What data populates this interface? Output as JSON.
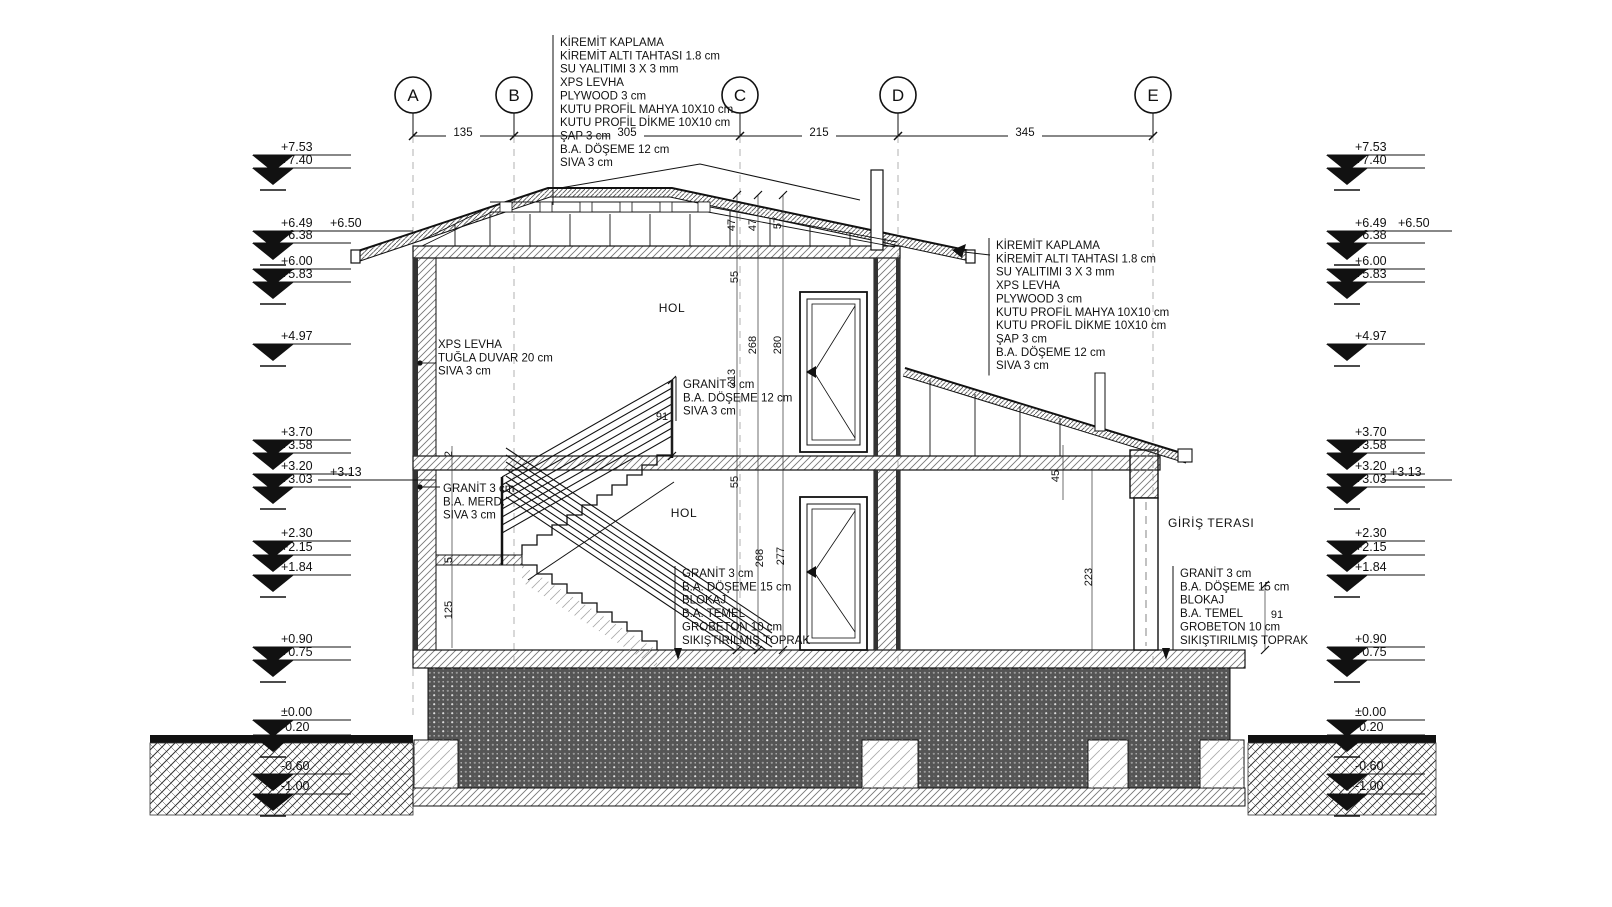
{
  "drawing": {
    "title": "building-cross-section",
    "colors": {
      "line": "#111111",
      "hatch": "#777777",
      "ground_fill": "#555555",
      "dash_grid": "#aaaaaa"
    },
    "grid": {
      "items": [
        {
          "label": "A",
          "x": 413
        },
        {
          "label": "B",
          "x": 514
        },
        {
          "label": "C",
          "x": 740
        },
        {
          "label": "D",
          "x": 898
        },
        {
          "label": "E",
          "x": 1153
        }
      ],
      "circle_y": 95,
      "dim_line_y": 136,
      "spans": [
        {
          "t": "135",
          "x": 463
        },
        {
          "t": "305",
          "x": 627
        },
        {
          "t": "215",
          "x": 819
        },
        {
          "t": "345",
          "x": 1025
        }
      ]
    },
    "levels": {
      "left_tip_x": 273,
      "right_tip_x": 1347,
      "items": [
        {
          "v": "+7.53",
          "y": 151
        },
        {
          "v": "+7.40",
          "y": 164,
          "u": 1
        },
        {
          "v": "+6.49",
          "y": 227
        },
        {
          "v": "+6.38",
          "y": 239,
          "u": 1
        },
        {
          "v": "+6.00",
          "y": 265
        },
        {
          "v": "+5.83",
          "y": 278,
          "u": 1
        },
        {
          "v": "+4.97",
          "y": 340,
          "u": 1
        },
        {
          "v": "+3.70",
          "y": 436
        },
        {
          "v": "+3.58",
          "y": 449,
          "u": 1
        },
        {
          "v": "+3.20",
          "y": 470
        },
        {
          "v": "+3.03",
          "y": 483,
          "u": 1
        },
        {
          "v": "+2.30",
          "y": 537
        },
        {
          "v": "+2.15",
          "y": 551,
          "u": 1
        },
        {
          "v": "+1.84",
          "y": 571,
          "u": 1
        },
        {
          "v": "+0.90",
          "y": 643
        },
        {
          "v": "+0.75",
          "y": 656,
          "u": 1
        },
        {
          "v": "±0.00",
          "y": 716
        },
        {
          "v": "-0.20",
          "y": 731,
          "u": 1
        },
        {
          "v": "-0.60",
          "y": 770
        },
        {
          "v": "-1.00",
          "y": 790,
          "u": 1
        }
      ],
      "extras": [
        {
          "v": "+6.50",
          "x": 330,
          "y": 227,
          "x1": 318,
          "x2": 413,
          "ly": 231
        },
        {
          "v": "+3.13",
          "x": 330,
          "y": 476,
          "x1": 318,
          "x2": 436,
          "ly": 480
        },
        {
          "v": "+6.50",
          "x": 1398,
          "y": 227,
          "x1": 1390,
          "x2": 1452,
          "ly": 231
        },
        {
          "v": "+3.13",
          "x": 1390,
          "y": 476,
          "x1": 1382,
          "x2": 1452,
          "ly": 480
        }
      ]
    },
    "specs": {
      "roof_top": {
        "x": 560,
        "y": 46,
        "bar": true,
        "bar_y2": 205,
        "lines": [
          "KİREMİT KAPLAMA",
          "KİREMİT ALTI TAHTASI 1.8 cm",
          "SU YALITIMI 3 X 3 mm",
          "XPS LEVHA",
          "PLYWOOD 3 cm",
          "KUTU PROFİL MAHYA 10X10 cm",
          "KUTU PROFİL DİKME 10X10 cm",
          "ŞAP 3 cm",
          "B.A. DÖŞEME 12 cm",
          "SIVA 3 cm"
        ]
      },
      "roof_right": {
        "x": 996,
        "y": 249,
        "bar": true,
        "lines": [
          "KİREMİT KAPLAMA",
          "KİREMİT ALTI TAHTASI 1.8 cm",
          "SU YALITIMI 3 X 3 mm",
          "XPS LEVHA",
          "PLYWOOD 3 cm",
          "KUTU PROFİL MAHYA 10X10 cm",
          "KUTU PROFİL DİKME 10X10 cm",
          "ŞAP 3 cm",
          "B.A. DÖŞEME 12 cm",
          "SIVA 3 cm"
        ]
      },
      "wall_left": {
        "x": 438,
        "y": 348,
        "bar": false,
        "lines": [
          "XPS LEVHA",
          "TUĞLA DUVAR 20 cm",
          "SIVA 3 cm"
        ]
      },
      "stair": {
        "x": 443,
        "y": 492,
        "bar": false,
        "lines": [
          "GRANİT 3 cm",
          "B.A. MERD.",
          "SIVA 3 cm"
        ]
      },
      "mid_slab": {
        "x": 683,
        "y": 388,
        "bar": true,
        "lines": [
          "GRANİT 3 cm",
          "B.A. DÖŞEME 12 cm",
          "SIVA 3 cm"
        ]
      },
      "ground_mid": {
        "x": 682,
        "y": 577,
        "bar": true,
        "lines": [
          "GRANİT 3 cm",
          "B.A. DÖŞEME 15 cm",
          "BLOKAJ",
          "B.A. TEMEL",
          "GROBETON 10 cm",
          "SIKIŞTIRILMIŞ TOPRAK"
        ]
      },
      "ground_right": {
        "x": 1180,
        "y": 577,
        "bar": true,
        "lines": [
          "GRANİT 3 cm",
          "B.A. DÖŞEME 15 cm",
          "BLOKAJ",
          "B.A. TEMEL",
          "GROBETON 10 cm",
          "SIKIŞTIRILMIŞ TOPRAK"
        ]
      }
    },
    "rooms": {
      "hol_upper": "HOL",
      "hol_lower": "HOL",
      "giris_terasi": "GİRİŞ TERASI"
    },
    "dims": [
      {
        "t": "47",
        "x": 735,
        "y": 225,
        "r": 1
      },
      {
        "t": "47",
        "x": 756,
        "y": 225,
        "r": 1
      },
      {
        "t": "57",
        "x": 781,
        "y": 223,
        "r": 1
      },
      {
        "t": "55",
        "x": 738,
        "y": 277,
        "r": 1
      },
      {
        "t": "268",
        "x": 756,
        "y": 345,
        "r": 1
      },
      {
        "t": "280",
        "x": 781,
        "y": 345,
        "r": 1
      },
      {
        "t": "213",
        "x": 735,
        "y": 378,
        "r": 1
      },
      {
        "t": "55",
        "x": 738,
        "y": 482,
        "r": 1
      },
      {
        "t": "268",
        "x": 763,
        "y": 558,
        "r": 1
      },
      {
        "t": "277",
        "x": 784,
        "y": 556,
        "r": 1
      },
      {
        "t": "45",
        "x": 1059,
        "y": 476,
        "r": 1
      },
      {
        "t": "223",
        "x": 1092,
        "y": 577,
        "r": 1
      },
      {
        "t": "2",
        "x": 452,
        "y": 454,
        "r": 1
      },
      {
        "t": "5",
        "x": 452,
        "y": 560,
        "r": 1
      },
      {
        "t": "125",
        "x": 452,
        "y": 610,
        "r": 1
      },
      {
        "t": "91",
        "x": 662,
        "y": 420,
        "r": 0
      },
      {
        "t": "91",
        "x": 1277,
        "y": 618,
        "r": 0
      }
    ]
  }
}
